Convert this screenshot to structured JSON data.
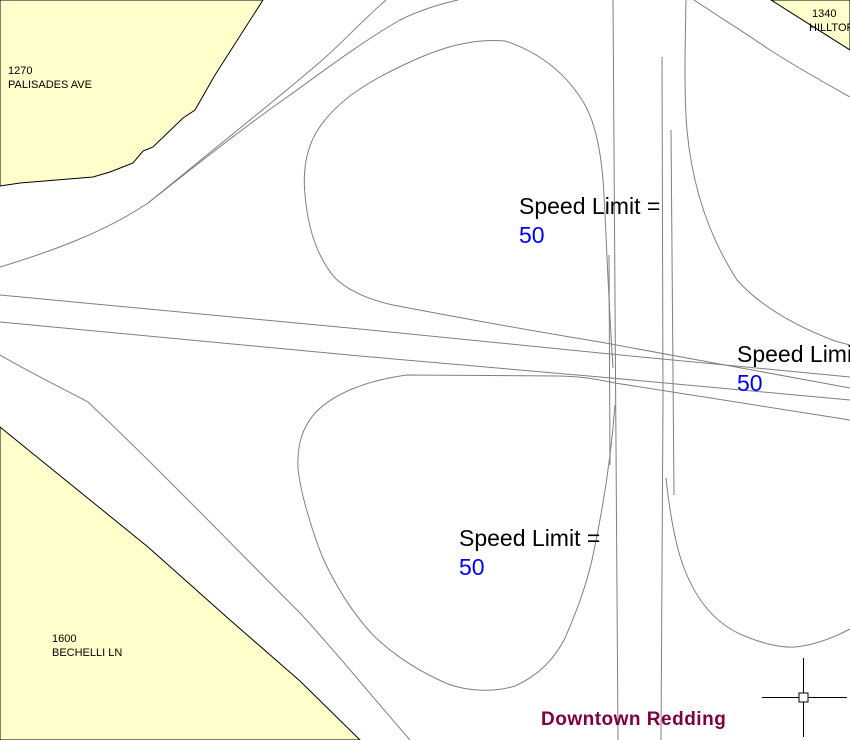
{
  "canvas": {
    "width": 850,
    "height": 740,
    "background": "#FFFFFF"
  },
  "zones": [
    {
      "position": "top-left",
      "address_number": "1270",
      "street_name": "PALISADES AVE"
    },
    {
      "position": "top-right",
      "address_number": "1340",
      "street_name": "HILLTOP"
    },
    {
      "position": "bottom-left",
      "address_number": "1600",
      "street_name": "BECHELLI LN"
    }
  ],
  "speed_limit_labels": [
    {
      "text": "Speed Limit =",
      "value": "50"
    },
    {
      "text": "Speed Limit =",
      "value": "50"
    },
    {
      "text": "Speed Limit =",
      "value": "50"
    }
  ],
  "area_label": {
    "text": "Downtown Redding"
  },
  "colors": {
    "zone_fill": "#FFFFCC",
    "zone_border": "#000000",
    "road_line": "#7F7F7F",
    "speed_value": "#0000FF",
    "label_text": "#000000",
    "area_label": "#800040",
    "crosshair": "#000000"
  }
}
